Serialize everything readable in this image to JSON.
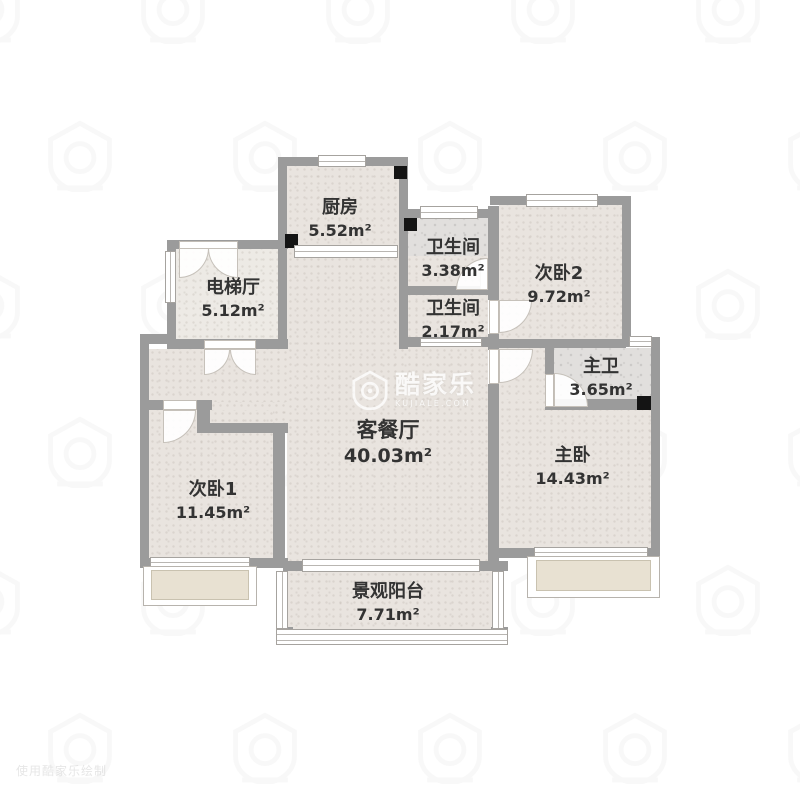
{
  "watermark": {
    "brand": "酷家乐",
    "brand_domain": "KUJIALE.COM",
    "logo_name": "kujiale-house-logo",
    "corner_text": "使用酷家乐绘制"
  },
  "floorplan": {
    "rooms": [
      {
        "id": "kitchen",
        "name": "厨房",
        "area": "5.52m²"
      },
      {
        "id": "bathroom-1",
        "name": "卫生间",
        "area": "3.38m²"
      },
      {
        "id": "bathroom-2",
        "name": "卫生间",
        "area": "2.17m²"
      },
      {
        "id": "bedroom-2",
        "name": "次卧2",
        "area": "9.72m²"
      },
      {
        "id": "elevator-hall",
        "name": "电梯厅",
        "area": "5.12m²"
      },
      {
        "id": "master-bath",
        "name": "主卫",
        "area": "3.65m²"
      },
      {
        "id": "living-dining",
        "name": "客餐厅",
        "area": "40.03m²"
      },
      {
        "id": "master-bedroom",
        "name": "主卧",
        "area": "14.43m²"
      },
      {
        "id": "bedroom-1",
        "name": "次卧1",
        "area": "11.45m²"
      },
      {
        "id": "balcony",
        "name": "景观阳台",
        "area": "7.71m²"
      }
    ],
    "colors": {
      "wall": "#9b9b9b",
      "floor": "#e9e4df",
      "tile": "#e1dfdd",
      "bay": "#e8e1d2",
      "pillar": "#141414",
      "text": "#333333"
    }
  }
}
